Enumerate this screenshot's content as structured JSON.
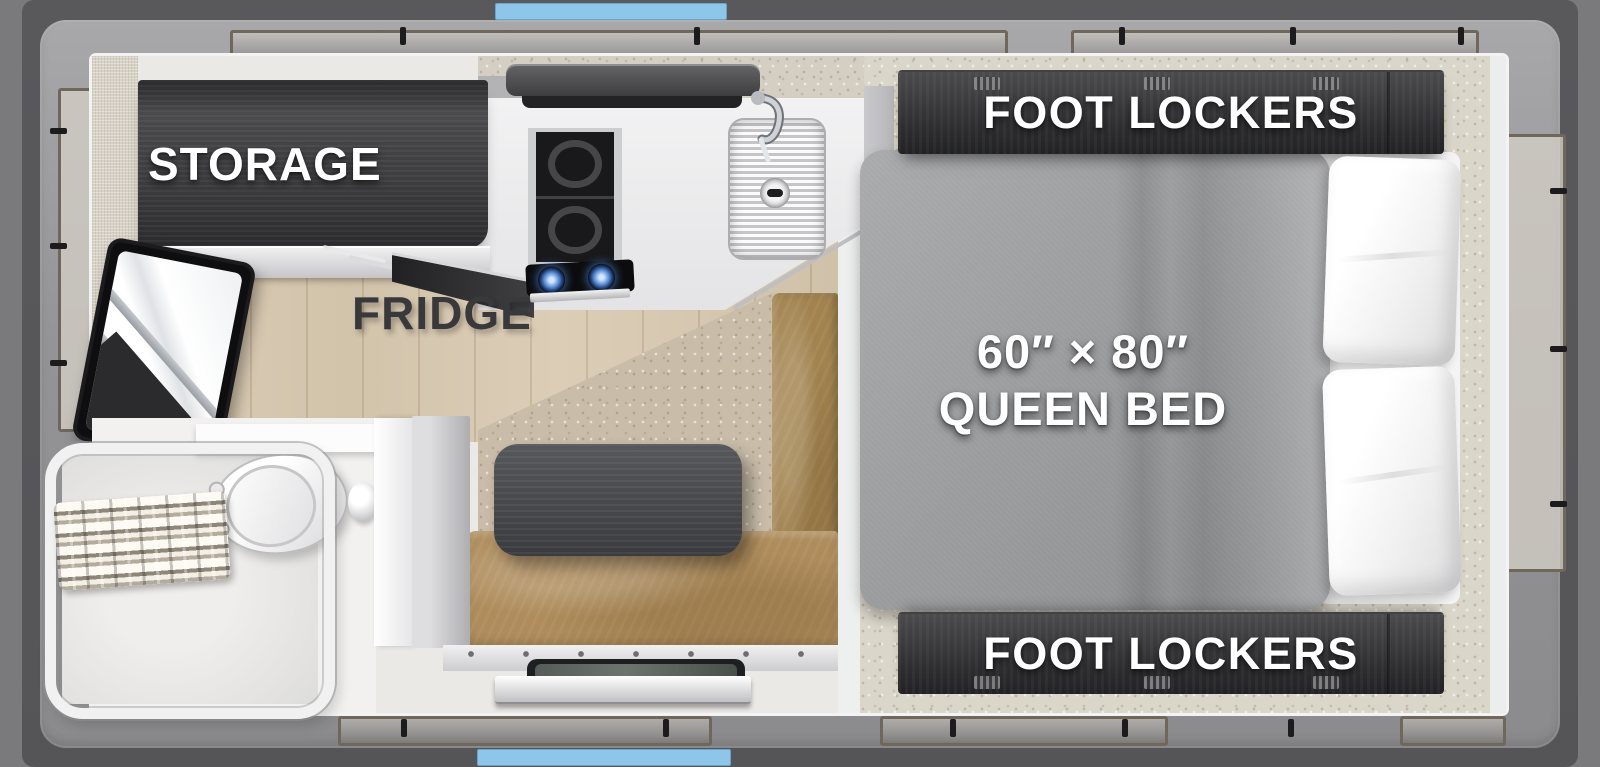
{
  "floorplan": {
    "labels": {
      "storage": "STORAGE",
      "fridge": "FRIDGE",
      "foot_lockers_top": "FOOT LOCKERS",
      "foot_lockers_bottom": "FOOT LOCKERS",
      "bed_size": "60″ × 80″",
      "bed_type": "QUEEN BED"
    },
    "colors": {
      "accent_blue": "#8EC6EA",
      "shell_gray": "#57575A",
      "wall_band_gray": "#939395",
      "cabinet_dark": "#343437",
      "bench_tan": "#AE8C5B",
      "mattress_gray": "#9B9C9E",
      "carpet_beige": "#C9BCA9",
      "wood_floor_tan": "#D8C9B2",
      "window_frame_taupe": "#6F675C"
    },
    "fixtures": [
      "storage-cabinet",
      "tv",
      "range-hood",
      "oven",
      "cooktop-burners",
      "sink",
      "faucet",
      "dinette-table",
      "bench-seat",
      "carpet",
      "wood-floor",
      "toilet",
      "shower-enclosure",
      "accordion-door",
      "entry-step",
      "queen-bed",
      "pillows",
      "foot-lockers",
      "windows"
    ]
  }
}
